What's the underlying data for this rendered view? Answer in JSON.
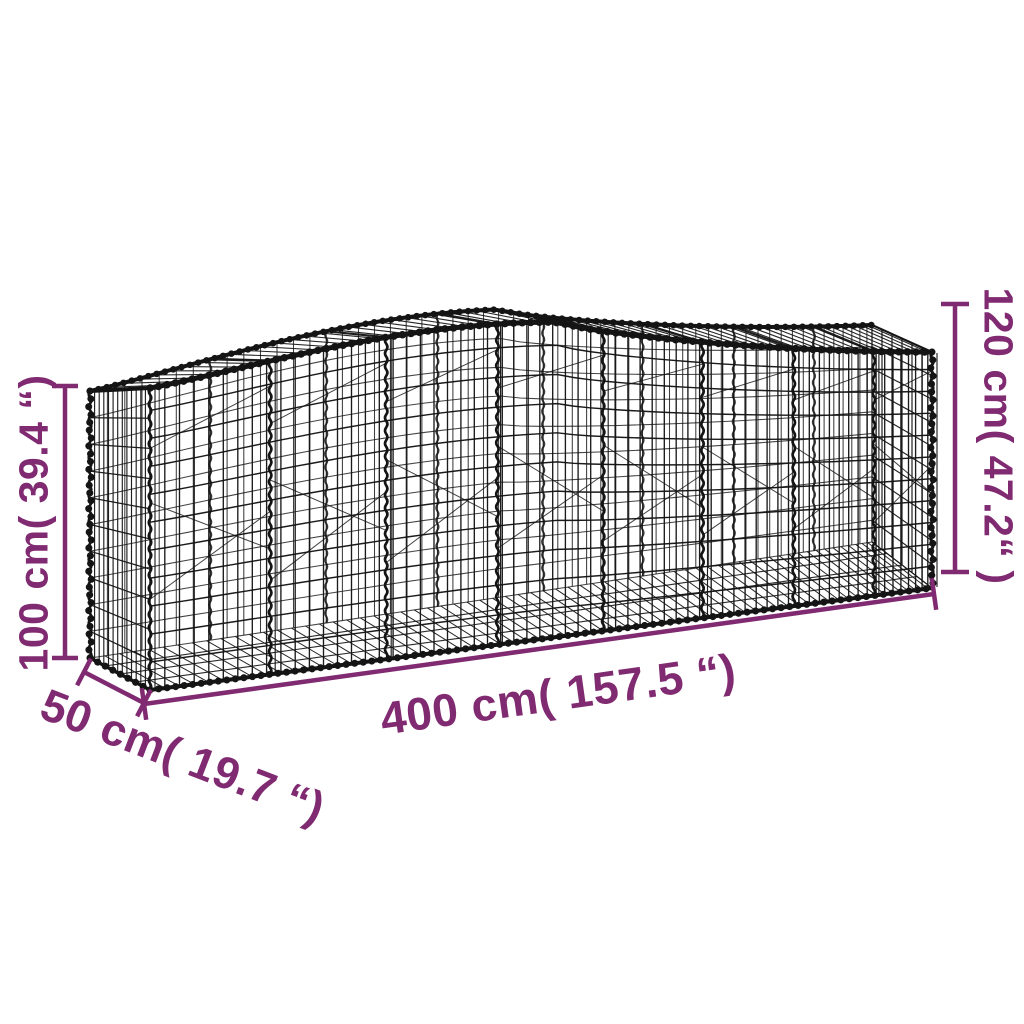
{
  "diagram": {
    "subject": "arched gabion mesh basket with dimension annotations",
    "background": "#ffffff"
  },
  "colors": {
    "wire": "#141414",
    "dimension": "#802a71",
    "background": "#ffffff"
  },
  "dimensions": {
    "height_left": {
      "label": "100 cm( 39.4 “)"
    },
    "height_right": {
      "label": "120 cm( 47.2“ )"
    },
    "length": {
      "label": "400 cm( 157.5 “)"
    },
    "depth": {
      "label": "50 cm( 19.7 “)"
    }
  }
}
